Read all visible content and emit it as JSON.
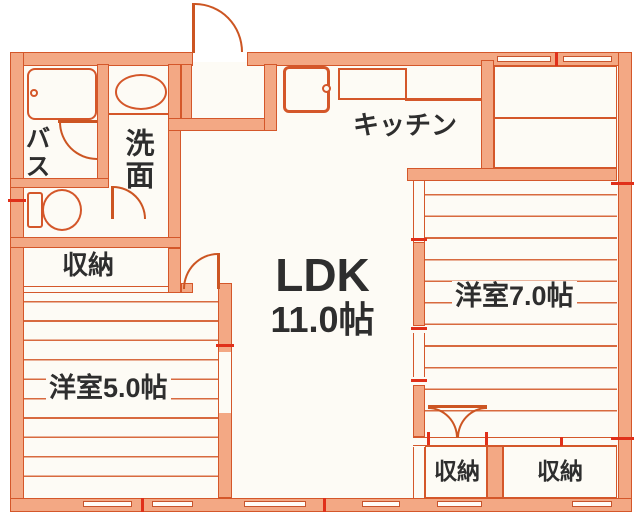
{
  "plan": {
    "type": "floorplan",
    "rooms": {
      "ldk": {
        "name": "LDK",
        "size": "11.0帖"
      },
      "kitchen": {
        "name": "キッチン"
      },
      "western7": {
        "name": "洋室7.0帖"
      },
      "western5": {
        "name": "洋室5.0帖"
      },
      "bath": {
        "name": "バス"
      },
      "washroom": {
        "name": "洗面"
      },
      "storage_hall": {
        "name": "収納"
      },
      "storage_w7_left": {
        "name": "収納"
      },
      "storage_w7_right": {
        "name": "収納"
      }
    },
    "colors": {
      "wall_fill": "#f3a884",
      "wall_line": "#d4572a",
      "floor_line": "#d86a3f",
      "joint_mark_red": "#e0301a",
      "text": "#2e2e2e",
      "paper": "#fdfbf5"
    }
  }
}
